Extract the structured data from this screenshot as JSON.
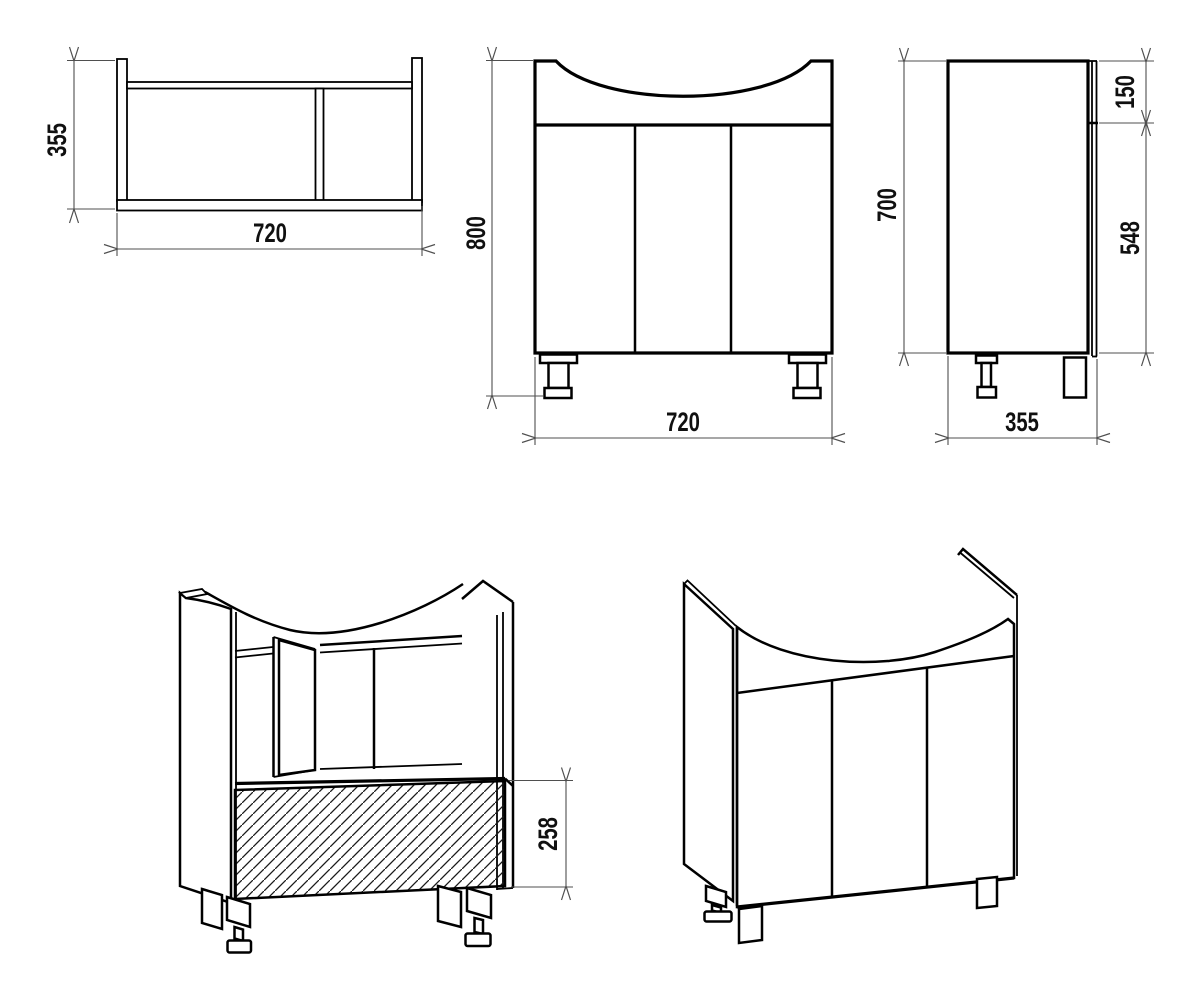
{
  "canvas": {
    "width": 1200,
    "height": 1002,
    "background": "#ffffff"
  },
  "style": {
    "outline_color": "#000000",
    "dimension_color": "#4f4f4f",
    "text_color": "#101010",
    "hatch_color": "#1a1a1a"
  },
  "views": {
    "plan": {
      "dim_depth": "355",
      "dim_width": "720"
    },
    "front": {
      "dim_height": "800",
      "dim_width": "720"
    },
    "side": {
      "dim_height": "700",
      "dim_top_frame": "150",
      "dim_door": "548",
      "dim_depth": "355"
    },
    "iso_open": {
      "dim_front_panel": "258"
    }
  }
}
